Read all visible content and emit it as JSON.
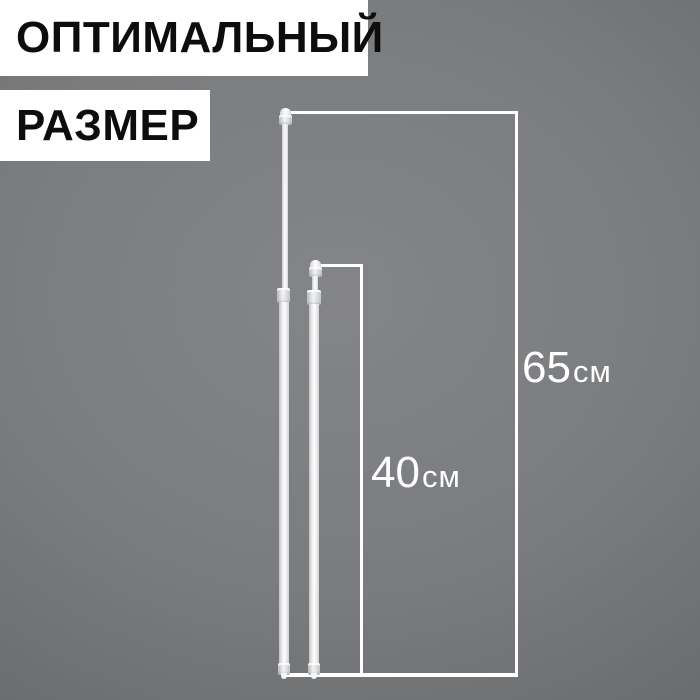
{
  "banner": {
    "line1": "ОПТИМАЛЬНЫЙ",
    "line2": "РАЗМЕР"
  },
  "dimensions": {
    "tall": {
      "value": "65",
      "unit": "см"
    },
    "short": {
      "value": "40",
      "unit": "см"
    }
  },
  "colors": {
    "background-center": "#848588",
    "background-edge": "#696b6c",
    "banner-bg": "#ffffff",
    "banner-text": "#0d0d0d",
    "dimension-line": "#ffffff",
    "dimension-label": "#ffffff"
  }
}
